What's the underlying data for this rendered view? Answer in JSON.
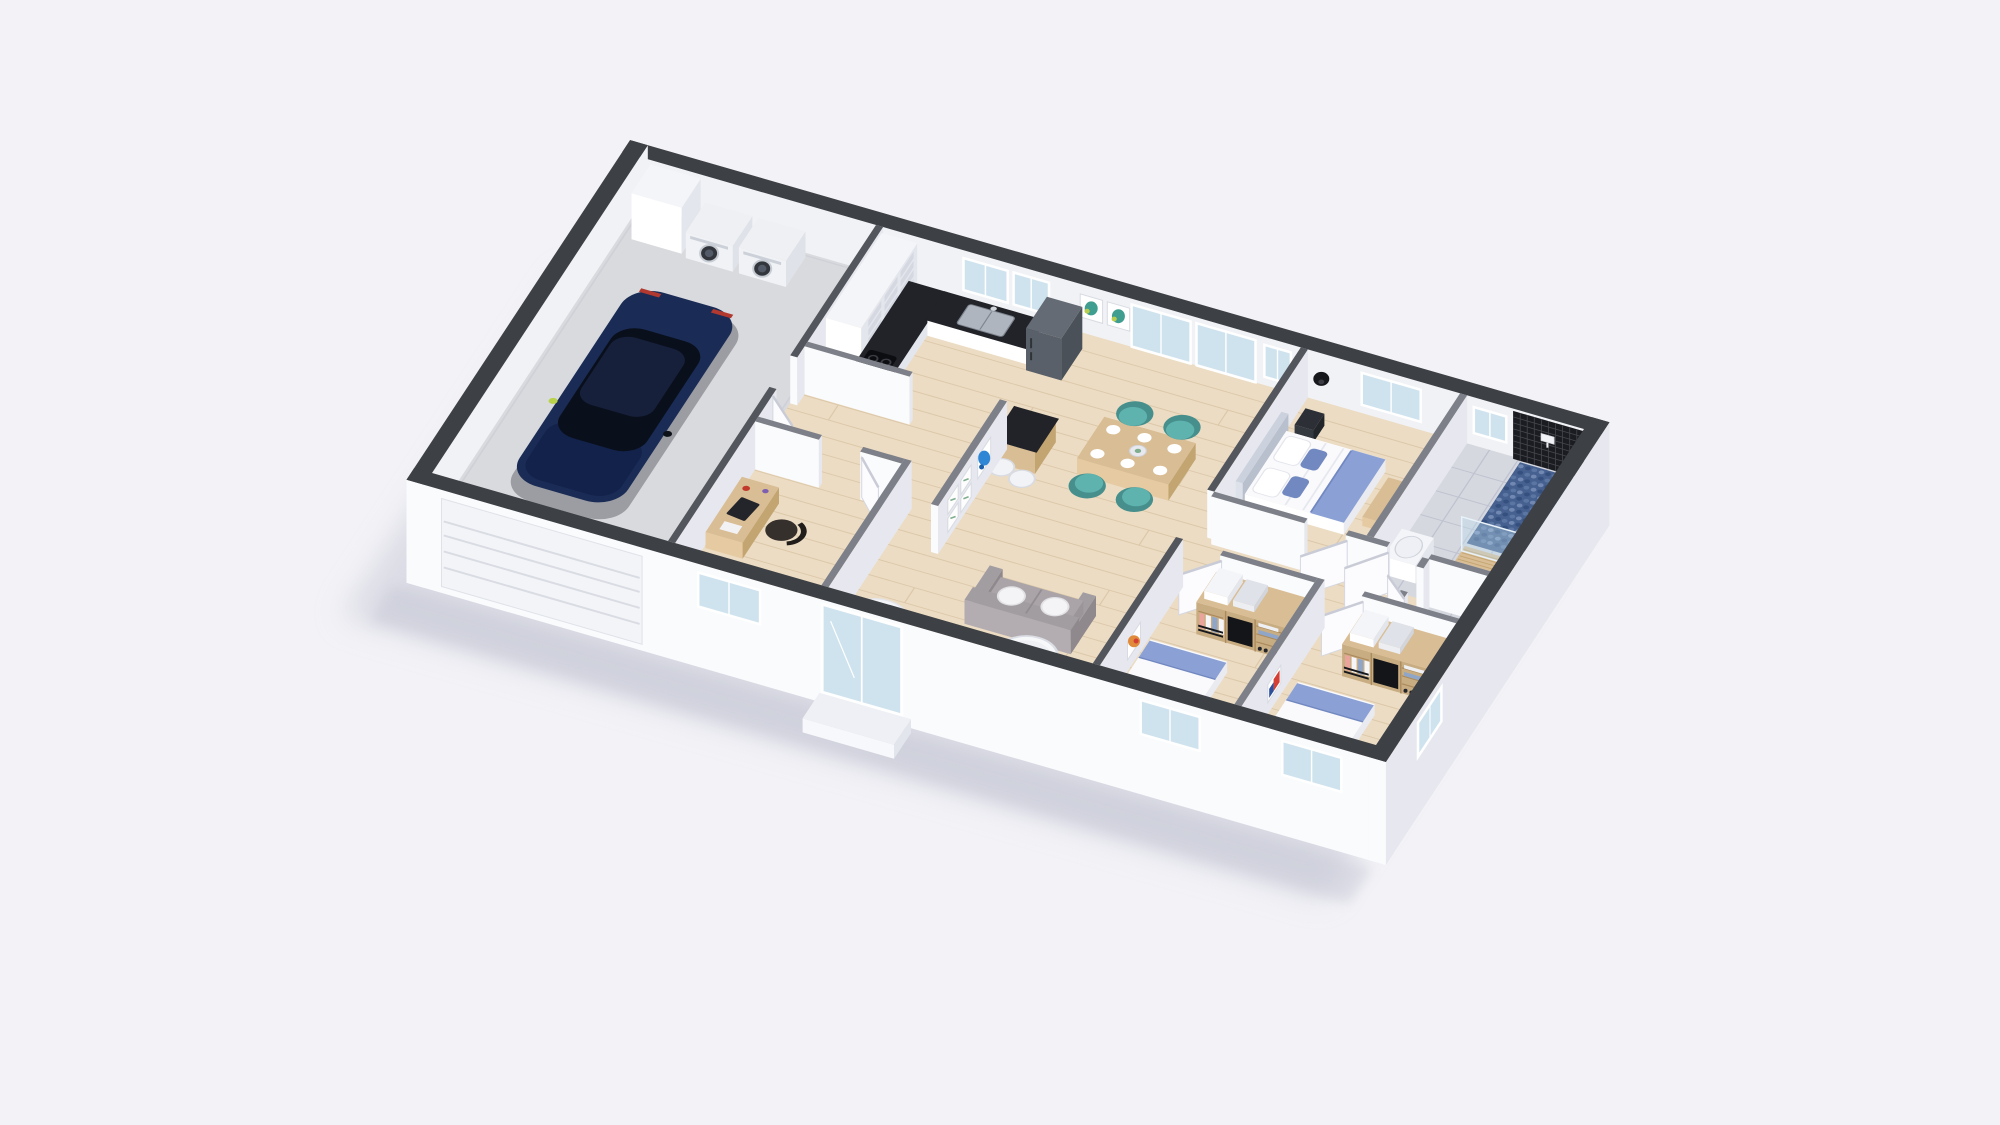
{
  "meta": {
    "title": "3D isometric dollhouse cutaway floor plan render of a single-storey house",
    "view": "axonometric top-down cutaway",
    "background": "#f3f3f7"
  },
  "palette": {
    "bg": "#f3f3f7",
    "shadow": "#c3c5d3",
    "extTop": "#3d4045",
    "intTop": "#7d8088",
    "intDark": "#53565c",
    "faceBright": "#fafbfd",
    "faceShade": "#e7e8ef",
    "faceInner": "#f1f2f6",
    "wood": "#ecdcc3",
    "woodLine": "#dcc7a8",
    "garage": "#d9dade",
    "tile": "#d6d8e0",
    "tileLine": "#bfc3cf",
    "marble": "#212329",
    "cabinet": "#f4f5f8",
    "cabinetShade": "#e4e6ed",
    "cubby": "#d5d8e1",
    "white": "#ffffff",
    "appliance": "#f1f2f5",
    "applianceDoor": "#33373d",
    "ring": "#c7ccd4",
    "fridgeTop": "#646b74",
    "fridgeFront": "#596069",
    "fridgeSide": "#4a5159",
    "carBody": "#1a2c55",
    "carBody2": "#13224a",
    "carRoof": "#0a0f1c",
    "carGlass": "#16203a",
    "carLight": "#b8d24a",
    "teal": "#5fb3af",
    "tealDark": "#468f8c",
    "woodF": "#d9bd94",
    "woodFHi": "#e6cba2",
    "woodFShade": "#c3a571",
    "duvet": "#fafafc",
    "duvetShade": "#e9ebf1",
    "blue": "#8ba1d6",
    "blueDeep": "#7288c0",
    "sofa": "#a29da1",
    "sofaHi": "#b3adb1",
    "sofaDark": "#8f898d",
    "pillow": "#f4f4f6",
    "glass": "#cfe3ef",
    "mosaic": "#1b1c21",
    "mosaicLine": "#45474d",
    "pebbleBase": "#46618f",
    "pebbleDot": "#7189b2",
    "pebbleDark": "#35507e",
    "artTeal": "#3f9e8f",
    "artLime": "#b9cc4e",
    "artBlue": "#2e86d4",
    "artRed": "#d43f35",
    "artBlue2": "#2c4f9e",
    "artOrange": "#e08a3c",
    "clothesPink": "#eba49c",
    "clothesBlue": "#8fa6c9",
    "clothesWhite": "#f6f6f8",
    "green": "#7fae8e",
    "doorLeaf": "#fcfcfe",
    "doorEdge": "#d5d8e1"
  },
  "scene": {
    "rooms": [
      {
        "id": "garage",
        "label": "Garage",
        "floor": "concrete"
      },
      {
        "id": "laundry-corner",
        "label": "Laundry corner",
        "floor": "concrete"
      },
      {
        "id": "kitchen",
        "label": "Kitchen",
        "floor": "wood"
      },
      {
        "id": "inner-hall",
        "label": "Inner hall",
        "floor": "wood"
      },
      {
        "id": "home-office",
        "label": "Home office",
        "floor": "wood"
      },
      {
        "id": "entry-hall",
        "label": "Entry hall",
        "floor": "wood"
      },
      {
        "id": "living-dining",
        "label": "Open living / dining room",
        "floor": "wood"
      },
      {
        "id": "bedroom-hallway",
        "label": "Bedroom hallway",
        "floor": "wood"
      },
      {
        "id": "master-bedroom",
        "label": "Master bedroom",
        "floor": "wood"
      },
      {
        "id": "bathroom",
        "label": "Bathroom with walk-in shower",
        "floor": "tile"
      },
      {
        "id": "wc",
        "label": "WC",
        "floor": "tile"
      },
      {
        "id": "bedroom-2",
        "label": "Bedroom 2",
        "floor": "wood"
      },
      {
        "id": "bedroom-3",
        "label": "Bedroom 3",
        "floor": "wood"
      }
    ],
    "furniture": [
      {
        "room": "garage",
        "items": [
          "dark-blue-car",
          "washing-machine",
          "dryer",
          "tall-storage-cabinet",
          "sectional-garage-door"
        ]
      },
      {
        "room": "kitchen",
        "items": [
          "tall-cubby-cabinet",
          "l-shaped-counter-black-marble-top",
          "cooktop",
          "double-sink",
          "fridge",
          "two-framed-artworks"
        ]
      },
      {
        "room": "living-dining",
        "items": [
          "breakfast-bar-with-stools",
          "wood-dining-table",
          "four-teal-chairs",
          "plates",
          "gray-sofa",
          "white-pillows",
          "round-coffee-table",
          "entry-rug",
          "bird-artwork",
          "botanical-frames"
        ]
      },
      {
        "room": "home-office",
        "items": [
          "desk-with-laptop",
          "dark-chair"
        ]
      },
      {
        "room": "master-bedroom",
        "items": [
          "double-bed-white-duvet-blue-runner",
          "headboard",
          "nightstand",
          "foot-bench",
          "black-wall-sconce"
        ]
      },
      {
        "room": "bathroom",
        "items": [
          "black-mosaic-shower-wall",
          "blue-pebble-shower-floor",
          "glass-screen",
          "wood-mat",
          "vanity-basin",
          "shower-fixture"
        ]
      },
      {
        "room": "wc",
        "items": [
          "wall-hung-toilet"
        ]
      },
      {
        "room": "bedroom-2",
        "items": [
          "open-wardrobe-with-clothes",
          "single-bed-blue-accents",
          "orange-artwork"
        ]
      },
      {
        "room": "bedroom-3",
        "items": [
          "open-wardrobe-with-clothes",
          "single-bed-blue-accents",
          "red-blue-artwork"
        ]
      }
    ],
    "openings": [
      "kitchen-windows",
      "living-sliding-glass-doors",
      "master-window",
      "bathroom-window",
      "office-window",
      "entry-glass-door",
      "bedroom-2-window",
      "bedroom-3-windows"
    ]
  }
}
